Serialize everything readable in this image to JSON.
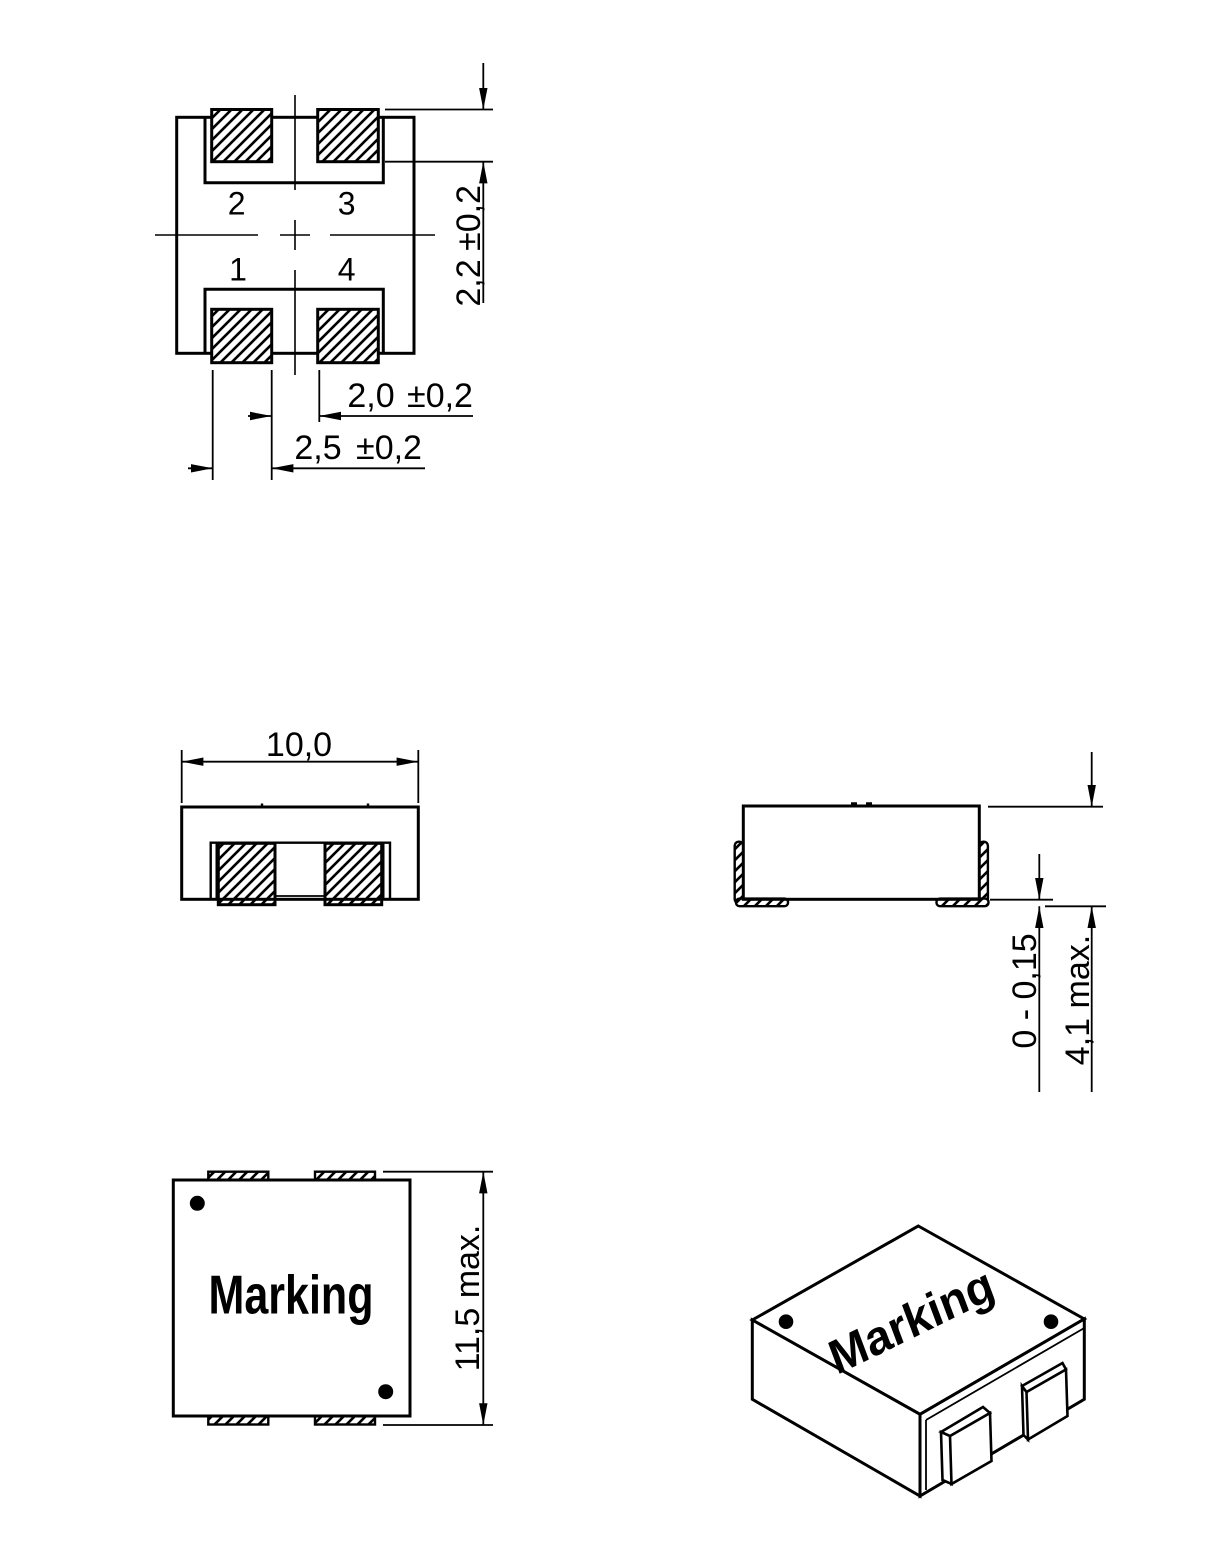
{
  "page": {
    "background": "#ffffff",
    "line_color": "#000000"
  },
  "views": {
    "land_pattern": {
      "pins": [
        "1",
        "2",
        "3",
        "4"
      ],
      "dim_pad_height": {
        "value": "2,2",
        "tol": "±0,2"
      },
      "dim_pad_gap": {
        "value": "2,0",
        "tol": "±0,2"
      },
      "dim_pad_width": {
        "value": "2,5",
        "tol": "±0,2"
      }
    },
    "front_view": {
      "dim_width": "10,0"
    },
    "side_view": {
      "dim_standoff": "0 - 0,15",
      "dim_height": "4,1 max."
    },
    "top_view": {
      "marking": "Marking",
      "dim_length": "11,5 max."
    },
    "iso_view": {
      "marking": "Marking"
    }
  }
}
